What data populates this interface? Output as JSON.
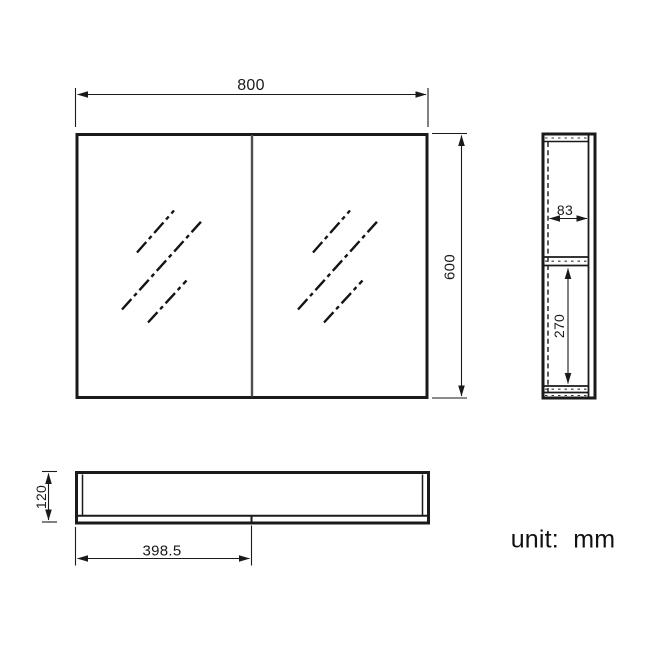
{
  "unit_note": {
    "text": "unit:  mm"
  },
  "dimensions": {
    "front_width": "800",
    "front_height": "600",
    "side_shelf_depth": "83",
    "side_lower_height": "270",
    "bottom_depth": "120",
    "bottom_door_width": "398.5"
  },
  "colors": {
    "outline": "#1a1a1a",
    "door_divider": "#4f4f4f",
    "dimension_line": "#1a1a1a",
    "background": "#ffffff"
  }
}
